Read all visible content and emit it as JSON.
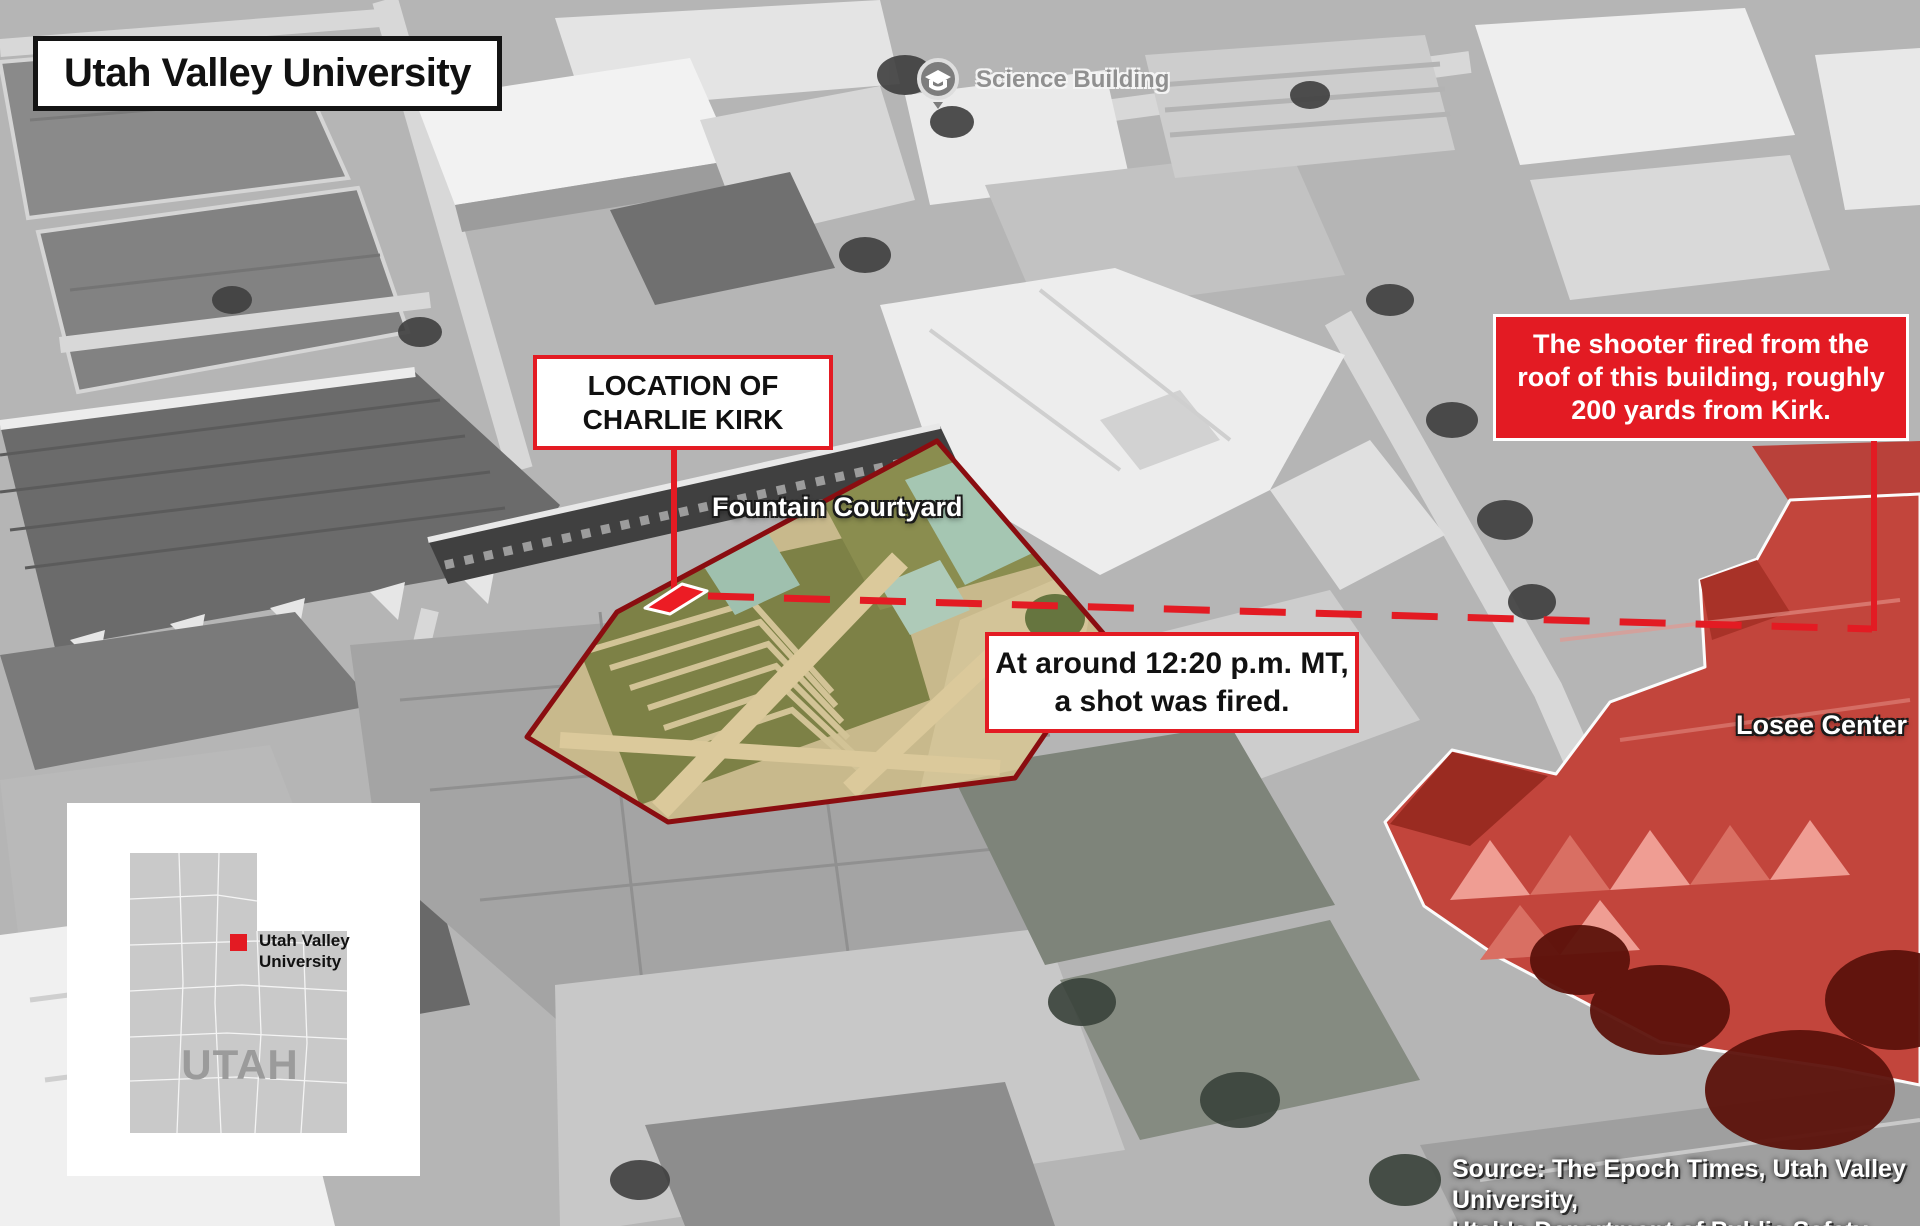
{
  "header": {
    "title": "Utah Valley University"
  },
  "map_labels": {
    "science_building": "Science Building",
    "fountain_courtyard": "Fountain Courtyard",
    "losee_center": "Losee Center"
  },
  "callouts": {
    "kirk_location": {
      "line1": "LOCATION OF",
      "line2": "CHARLIE KIRK"
    },
    "shooter": {
      "line1": "The shooter fired from the",
      "line2": "roof of this building, roughly",
      "line3": "200 yards from Kirk."
    },
    "shot_time": {
      "line1": "At around 12:20 p.m. MT,",
      "line2": "a shot was fired."
    }
  },
  "inset": {
    "state_label": "UTAH",
    "marker_label": {
      "line1": "Utah Valley",
      "line2": "University"
    }
  },
  "source": {
    "line1": "Source: The Epoch Times, Utah Valley University,",
    "line2": "Utah's Department of Public Safety"
  },
  "icons": {
    "science_pin": "graduation-cap-map-pin",
    "kirk_marker": "red-diamond-marker"
  },
  "colors": {
    "accent_red": "#e31b23",
    "courtyard_border_red": "#8a0d10",
    "losee_overlay_red": "#c2453c",
    "map_label_gray": "#909090",
    "inset_state_gray": "#c9c9c9"
  }
}
